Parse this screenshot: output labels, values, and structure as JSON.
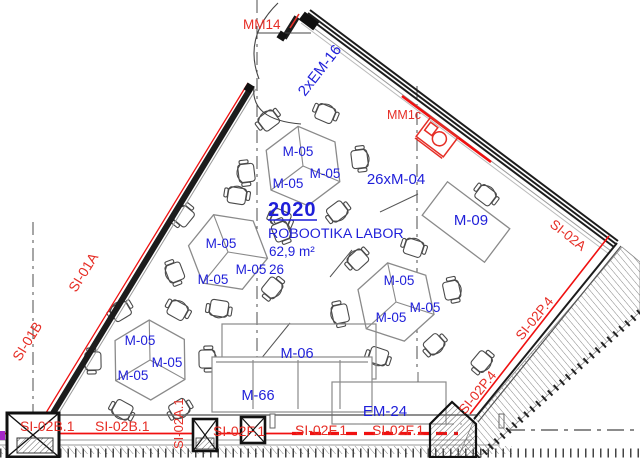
{
  "room": {
    "number": "2020",
    "name": "ROBOOTIKA LABOR",
    "area": "62,9 m²",
    "capacity": "26"
  },
  "furniture": {
    "table_group": "M-05",
    "chairs_total": "26xM-04",
    "desk": "M-09",
    "bench": "M-06",
    "cabinet": "M-66",
    "equipment": "EM-24",
    "door_unit": "2xEM-16"
  },
  "wall_labels": {
    "left_upper": "SI-01A",
    "left_lower": "SI-01B",
    "right_upper": "SI-02A",
    "bottom_inner_vertical": "SI-02A.1",
    "bottom_left": "SI-02B.1",
    "bottom_center": "SI-02F.1",
    "right_lower": "SI-02P.4"
  },
  "markers": {
    "door": "MM14",
    "device": "MM1c"
  },
  "colors": {
    "blue": "#1f1fd9",
    "red_text": "#e62e26",
    "red_line": "#f01010",
    "wall_dark": "#1c1c1c",
    "furniture_gray": "#8a8a8a",
    "grid_gray": "#4d4d4d",
    "magenta": "#a428c8"
  }
}
